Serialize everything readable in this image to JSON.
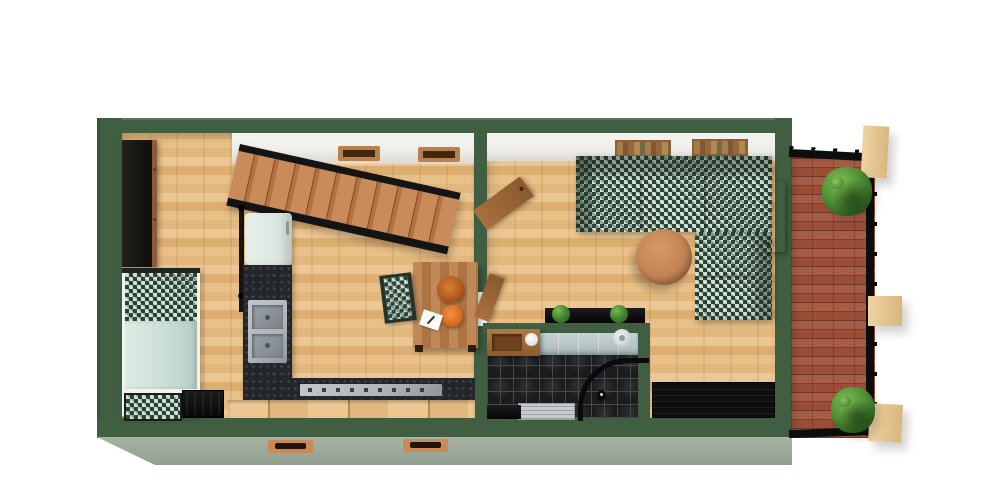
{
  "scene": {
    "title": "3D rendered floor plan, top-down view",
    "rooms": [
      {
        "name": "bedroom-kitchen",
        "furniture": [
          "dark wardrobe",
          "wooden staircase with black stringers",
          "stair handrail",
          "mint refrigerator",
          "dark speckled counter with double sink",
          "cooktop counter",
          "wood ledge bench",
          "single bed with houndstooth blanket and mint duvet",
          "houndstooth ottoman",
          "black slatted bench",
          "wooden dining table",
          "two orange bowls",
          "white note with pen",
          "houndstooth dining chair",
          "two wall vent niches"
        ]
      },
      {
        "name": "living-room",
        "furniture": [
          "L-shaped houndstooth sofa",
          "round wooden coffee table",
          "two wall book shelves",
          "black console with two potted plants",
          "black sideboard",
          "open wooden door to bedroom",
          "open wooden bathroom door",
          "open wooden door to patio"
        ]
      },
      {
        "name": "bathroom",
        "furniture": [
          "wooden vanity with white sink bowl",
          "shower head",
          "black curved shower rail",
          "grey shower tray",
          "toilet with wooden seat",
          "black tile floor",
          "blue-grey tiled wall"
        ]
      },
      {
        "name": "patio",
        "furniture": [
          "red brick floor",
          "black perimeter railing",
          "three timber beams",
          "green bush top",
          "green bush bottom"
        ]
      }
    ],
    "exterior": [
      "green painted walls",
      "sage exterior wall face with two wooden vents"
    ]
  },
  "palette": {
    "wall_green": "#3f5e42",
    "wall_green_dark": "#31492f",
    "exterior_sage": "#92a090",
    "exterior_sage_light": "#a9b3a2",
    "floor_light": "#ecc793",
    "floor_mid": "#e2b87e",
    "floor_light2": "#e8c088",
    "floor_dark": "#dcae72",
    "white_band": "#efeeea",
    "hound_dark": "#2f4438",
    "hound_light": "#cfe0d5",
    "duvet_mint": "#ccdfd8",
    "counter_black": "#23262b",
    "steel": "#aeb4b8",
    "fridge_mint": "#dce6e0",
    "stair_wood": "#c08352",
    "stringer_black": "#141414",
    "table_wood": "#b97e4e",
    "bowl_orange": "#b35a1f",
    "bowl_orange2": "#d96f23",
    "door_wood": "#a9703f",
    "brick_red": "#a2523a",
    "beam_tan": "#eed3a2",
    "plant_green": "#4e8f35",
    "tile_black": "#1a1c1e",
    "tile_wall": "#b7c4c6"
  }
}
